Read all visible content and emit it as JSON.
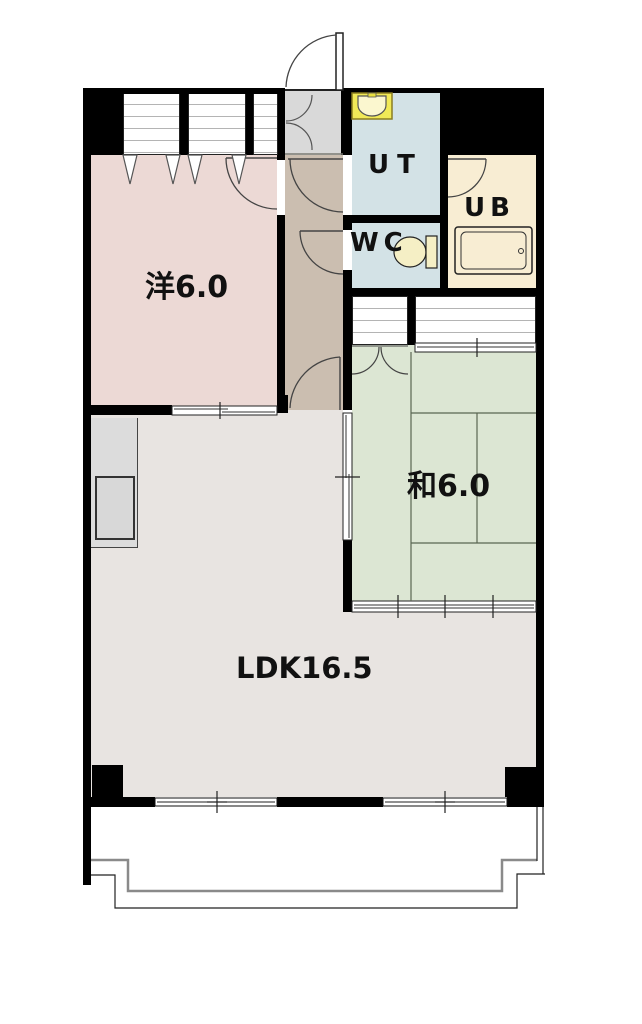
{
  "rooms": {
    "western": {
      "label": "洋6.0",
      "color": "#ecd9d5"
    },
    "japanese": {
      "label": "和6.0",
      "color": "#dce6d3"
    },
    "ldk": {
      "label": "LDK16.5",
      "color": "#e8e4e1"
    },
    "utility": {
      "label": "UT",
      "color": "#d3e2e6"
    },
    "toilet_room": {
      "label": "WC",
      "color": "#d3e2e6"
    },
    "bath": {
      "label": "UB",
      "color": "#f8edd3"
    },
    "hallway": {
      "color": "#cbbeb0"
    },
    "entry": {
      "color": "#d9d9d9"
    }
  },
  "fixtures": {
    "sink": "sink-icon",
    "toilet": "toilet-icon",
    "bathtub": "bathtub-icon",
    "kitchen_counter": "kitchen-counter"
  },
  "wall_color": "#000000",
  "balcony_outline_color": "#8a8a8a"
}
